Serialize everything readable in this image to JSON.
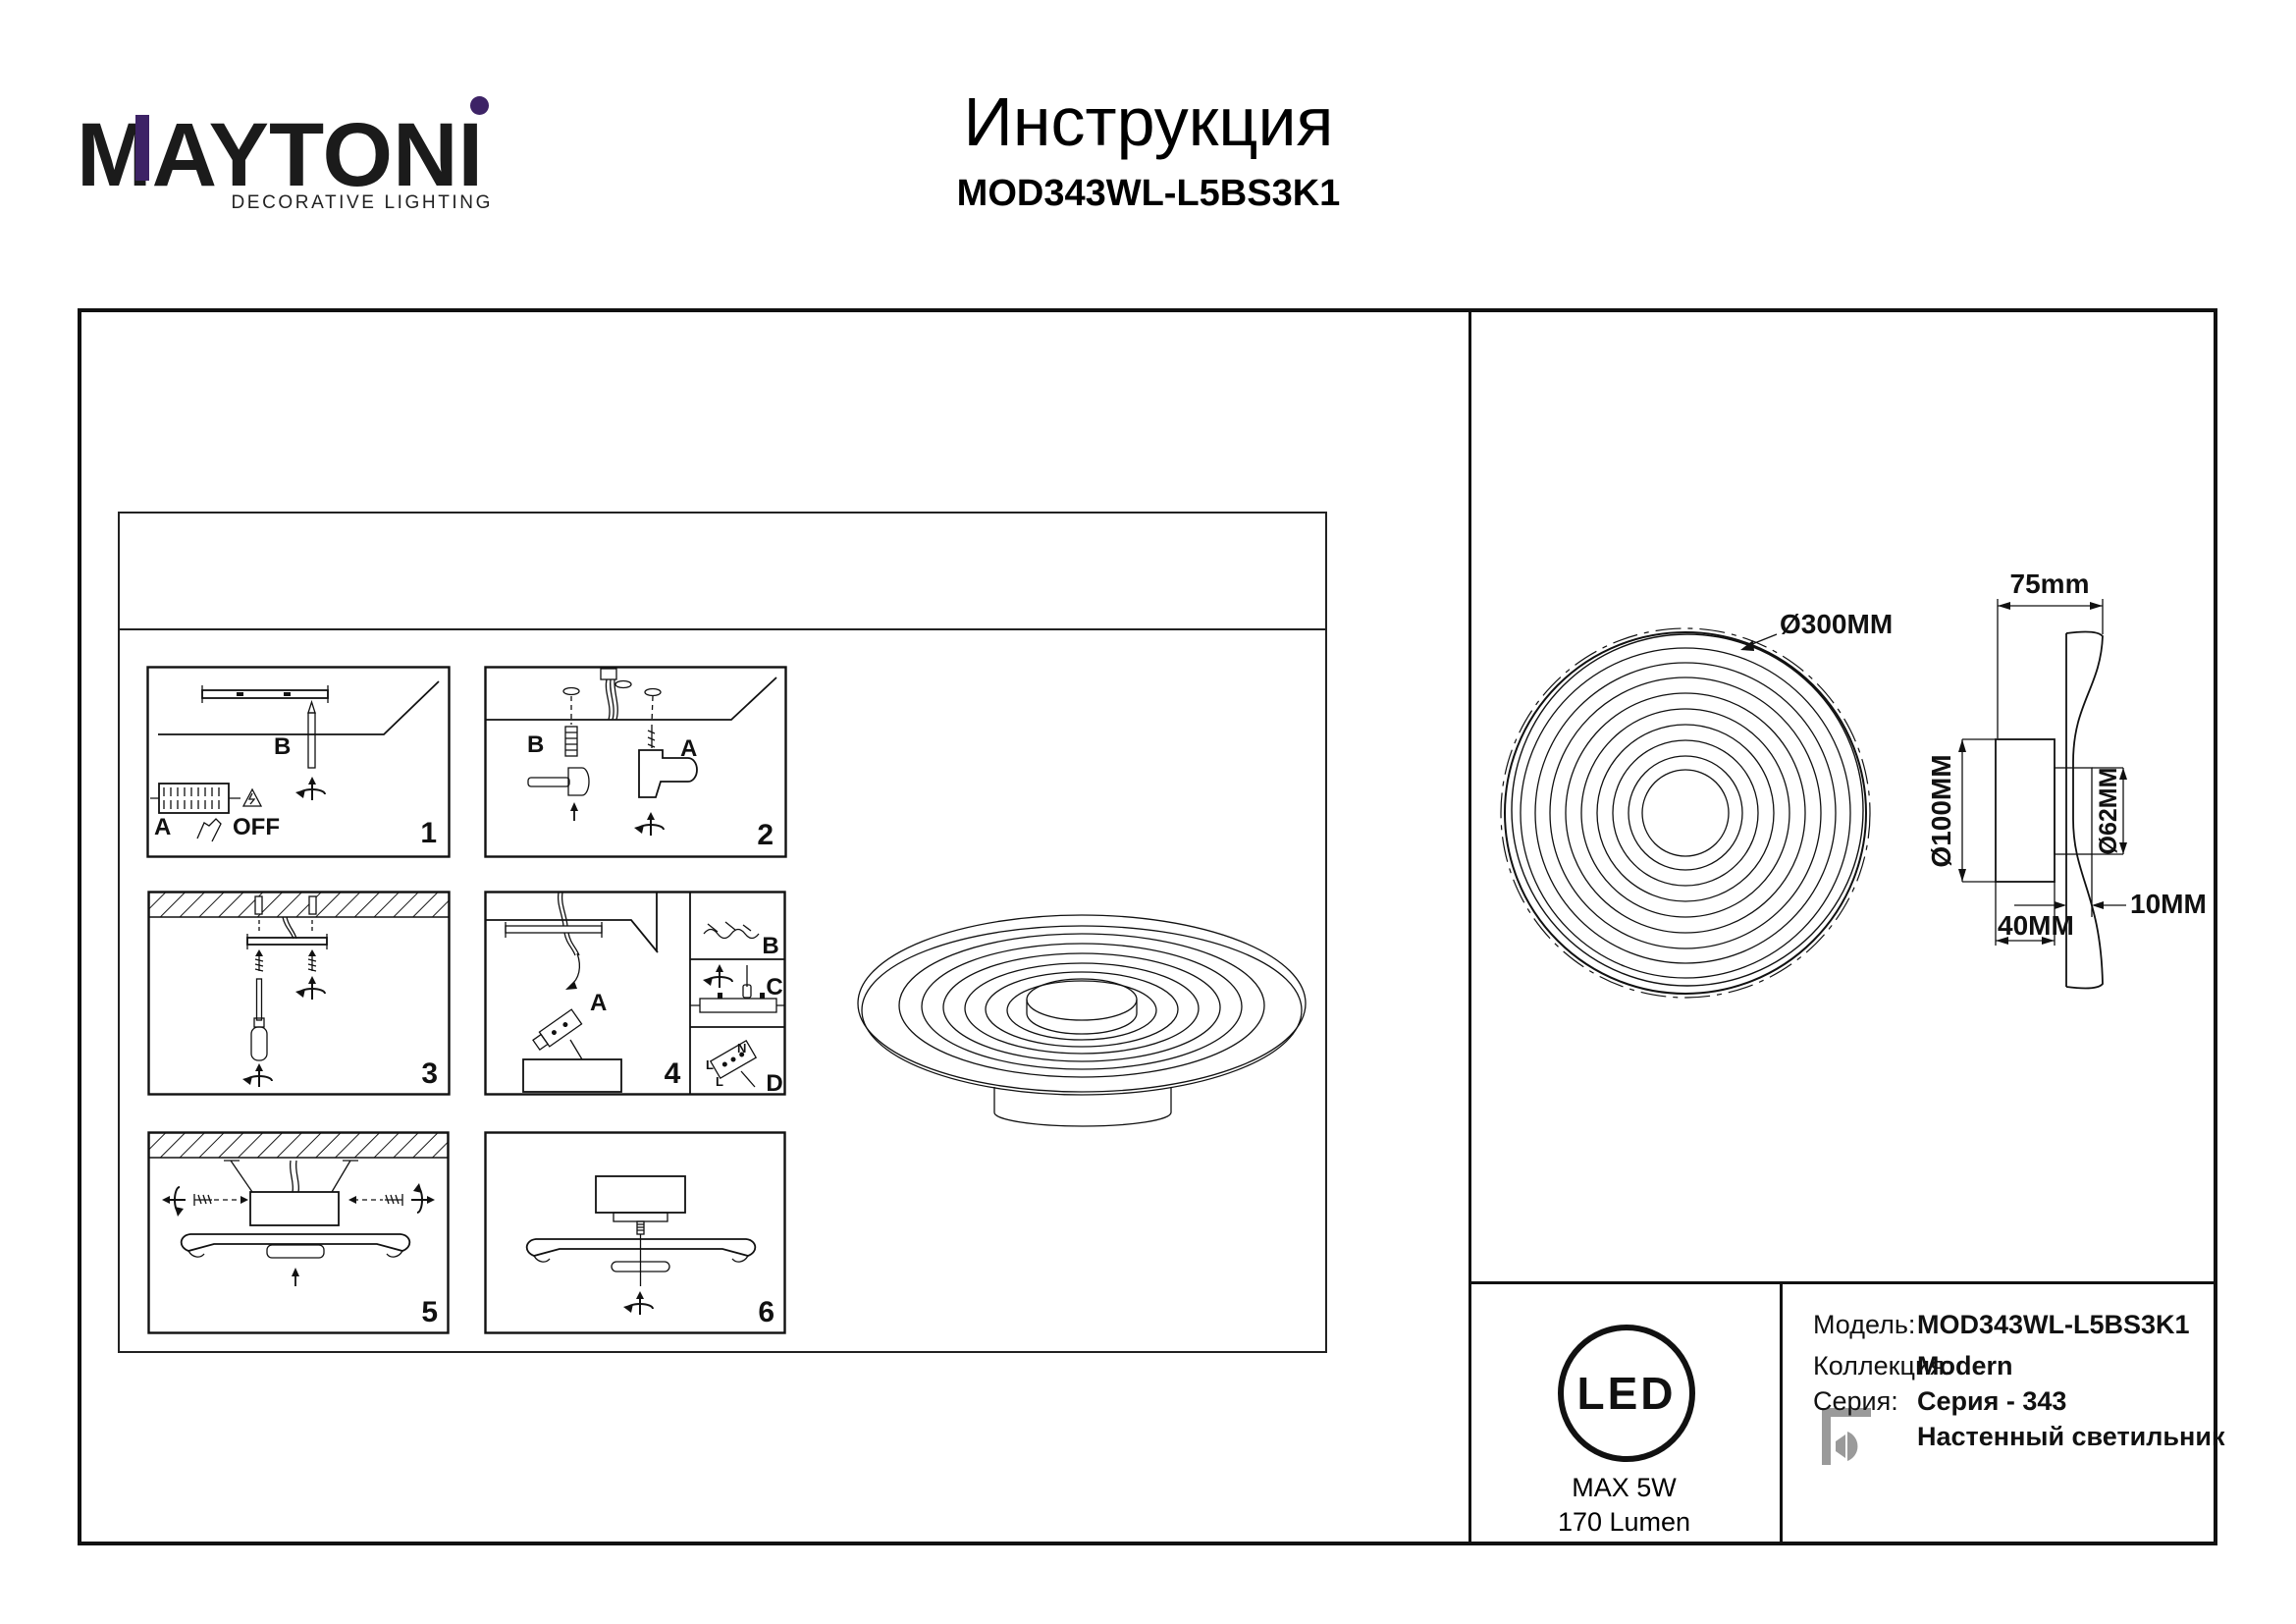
{
  "header": {
    "brand": "MAYTONI",
    "tagline": "DECORATIVE LIGHTING",
    "doc_title": "Инструкция",
    "doc_model": "MOD343WL-L5BS3K1"
  },
  "steps": {
    "s1": {
      "num": "1",
      "a": "A",
      "b": "B",
      "off": "OFF"
    },
    "s2": {
      "num": "2",
      "a": "A",
      "b": "B"
    },
    "s3": {
      "num": "3"
    },
    "s4": {
      "num": "4",
      "a": "A",
      "b": "B",
      "c": "C",
      "d": "D",
      "l1": "L",
      "n": "N",
      "l2": "L"
    },
    "s5": {
      "num": "5"
    },
    "s6": {
      "num": "6"
    }
  },
  "drawing": {
    "front_diameter": "Ø300MM",
    "width": "75mm",
    "back_diameter": "Ø100MM",
    "inner_diameter": "Ø62MM",
    "gap": "10MM",
    "depth": "40MM"
  },
  "spec": {
    "led_label": "LED",
    "max_power": "MAX 5W",
    "luminous_flux": "170 Lumen",
    "rows": [
      {
        "label": "Модель:",
        "value": "MOD343WL-L5BS3K1"
      },
      {
        "label": "Коллекция:",
        "value": "Modern"
      },
      {
        "label": "Серия:",
        "value": "Серия - 343"
      },
      {
        "label": "",
        "value": "Настенный светильник"
      }
    ]
  },
  "colors": {
    "accent_purple": "#3d2366",
    "icon_gray": "#9a9a9a"
  }
}
